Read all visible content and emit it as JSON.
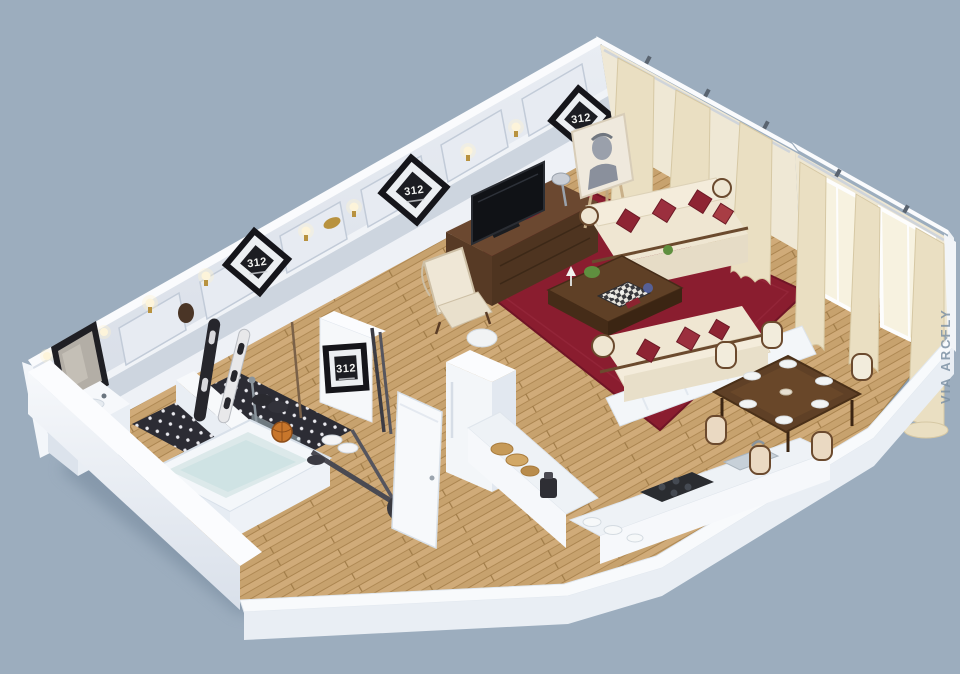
{
  "meta": {
    "watermark": "VIA ARCFLY",
    "image_type": "3D isometric apartment floor plan render",
    "unit_number": "312"
  },
  "frames": {
    "label": "312",
    "count": 4
  },
  "palette": {
    "background": "#9cadbe",
    "wall_white": "#f8fafc",
    "wall_face": "#dde3ec",
    "wainscot": "#cdd5df",
    "floor_wood": "#c7a26e",
    "carpet_red": "#8a1d2f",
    "sofa_cream": "#efe6d2",
    "pillow_red": "#8e2433",
    "wood_dark": "#5f4026",
    "curtain_cream": "#eadfc2",
    "bath_floor_black": "#2c2c34",
    "basketball_orange": "#c8762b"
  },
  "scene": {
    "rooms": [
      {
        "name": "living-room",
        "items": [
          "tv",
          "tv-console",
          "easel-portrait",
          "wingback-armchair",
          "cream-sofa",
          "chaise-lounge",
          "coffee-table",
          "chess-board",
          "red-carpet",
          "wall-sconces",
          "curtains",
          "number-frames"
        ]
      },
      {
        "name": "dining-area",
        "items": [
          "dining-table",
          "six-chairs",
          "place-settings",
          "windows-with-curtains"
        ]
      },
      {
        "name": "kitchen",
        "items": [
          "l-shaped-counter",
          "cooktop",
          "sink",
          "fridge-column",
          "bread",
          "plates",
          "coffee-maker"
        ]
      },
      {
        "name": "bathroom",
        "items": [
          "bathtub",
          "vanity",
          "framed-mirror",
          "polka-dot-floor",
          "shower"
        ]
      },
      {
        "name": "hallway",
        "items": [
          "snowboards",
          "skis",
          "boots",
          "basketball",
          "exercise-trainer",
          "sneakers",
          "open-door",
          "number-frame"
        ]
      }
    ]
  }
}
